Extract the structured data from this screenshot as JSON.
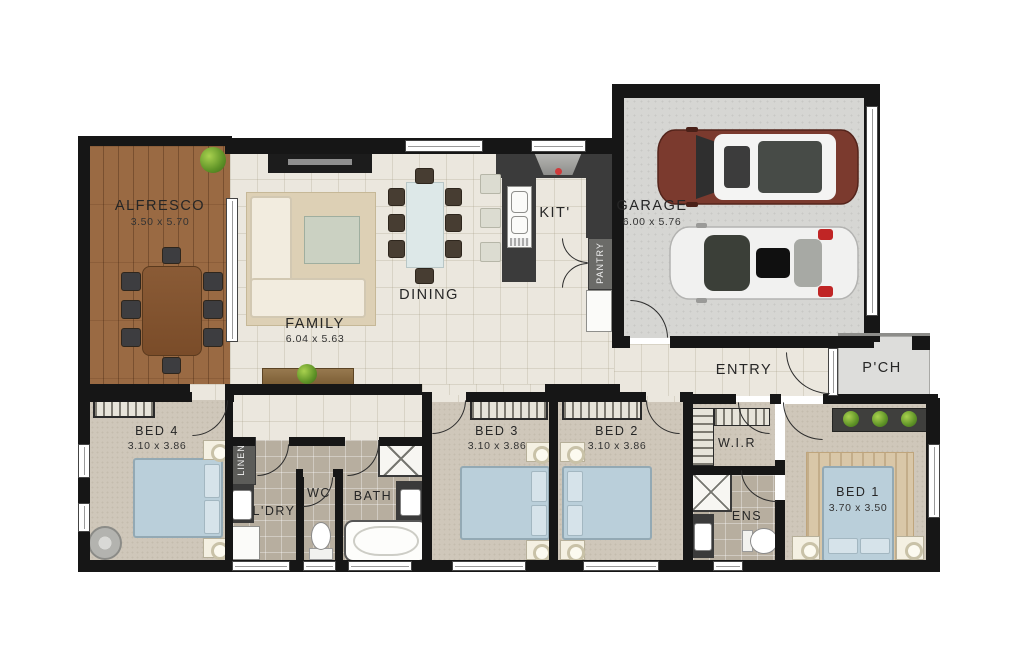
{
  "rooms": {
    "alfresco": {
      "label": "ALFRESCO",
      "dims": "3.50 x 5.70"
    },
    "family": {
      "label": "FAMILY",
      "dims": "6.04 x 5.63"
    },
    "dining": {
      "label": "DINING"
    },
    "kitchen": {
      "label": "KIT'"
    },
    "pantry": {
      "label": "PANTRY"
    },
    "garage": {
      "label": "GARAGE",
      "dims": "6.00 x 5.76"
    },
    "entry": {
      "label": "ENTRY"
    },
    "porch": {
      "label": "P'CH"
    },
    "bed4": {
      "label": "BED 4",
      "dims": "3.10 x 3.86"
    },
    "linen": {
      "label": "LINEN"
    },
    "laundry": {
      "label": "L'DRY"
    },
    "wc": {
      "label": "WC"
    },
    "bath": {
      "label": "BATH"
    },
    "bed3": {
      "label": "BED 3",
      "dims": "3.10 x 3.86"
    },
    "bed2": {
      "label": "BED 2",
      "dims": "3.10 x 3.86"
    },
    "wir": {
      "label": "W.I.R"
    },
    "ens": {
      "label": "ENS"
    },
    "bed1": {
      "label": "BED 1",
      "dims": "3.70 x 3.50"
    }
  },
  "palette": {
    "wall": "#161616",
    "tile_floor": "#ebe7de",
    "bath_tile": "#b7ae9f",
    "carpet": "#cfc7ba",
    "deck_wood": "#9a6a43",
    "garage_floor": "#d6d6d3",
    "bench_dark": "#3b3b3b",
    "bed_blue": "#bacfda",
    "suv_maroon": "#7b3a2e",
    "car_white": "#f2f2f1",
    "plant_green": "#5f9327"
  }
}
